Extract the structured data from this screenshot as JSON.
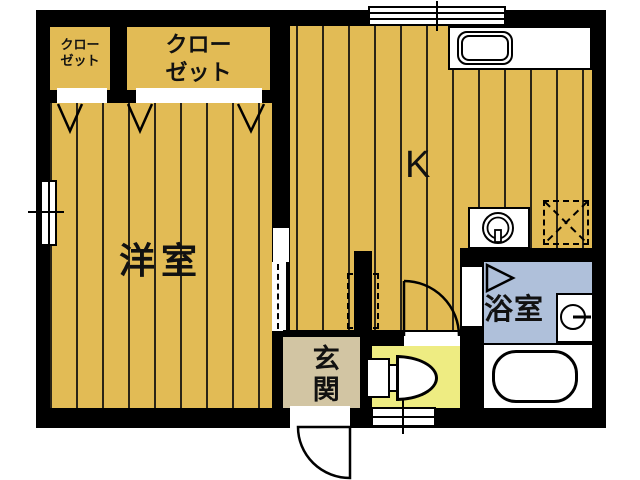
{
  "floorplan": {
    "rooms": {
      "western_room": {
        "label": "洋室"
      },
      "kitchen": {
        "label": "K"
      },
      "entrance": {
        "label": "玄関"
      },
      "bathroom": {
        "label": "浴室"
      },
      "closet_small": {
        "label": "クローゼット"
      },
      "closet_large": {
        "label": "クローゼット"
      }
    },
    "fixtures": {
      "kitchen_sink": "sink-icon",
      "stove": "burner-circle-icon",
      "refrigerator_space": "dashed-x-square-icon",
      "wash_basin": "basin-circle-icon",
      "bathtub": "bathtub-icon",
      "toilet": "toilet-icon",
      "entry_door": "door-swing-icon",
      "toilet_door": "door-swing-icon",
      "bath_folding_door": "folding-door-triangle-icon",
      "closet_doors": "v-mark-icon",
      "windows": "double-line-window-icon"
    },
    "colors": {
      "background": "#ffffff",
      "wall": "#000000",
      "wood_floor": "#e2bb55",
      "entrance_floor": "#d2c5a3",
      "toilet_floor": "#eeec82",
      "bathroom_floor": "#afc0da"
    }
  }
}
